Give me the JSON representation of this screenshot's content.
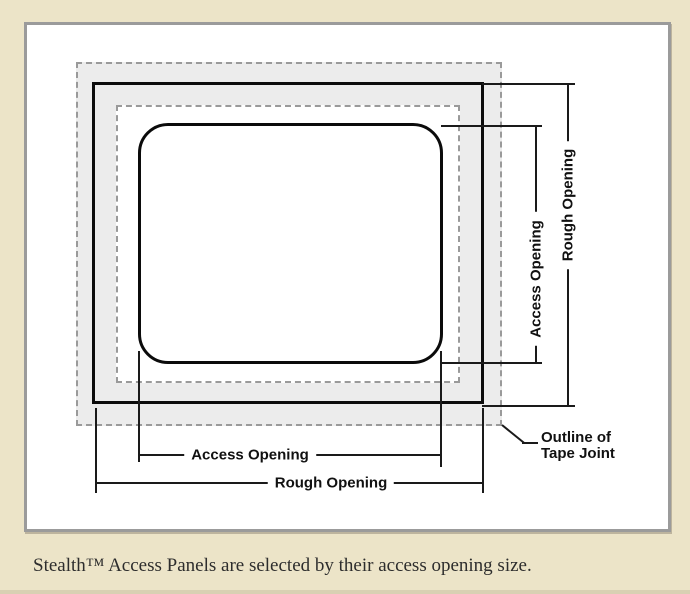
{
  "colors": {
    "page_background": "#ECE4C8",
    "panel_background": "#FFFFFF",
    "panel_border": "#9B9B9B",
    "tape_band_fill": "#ECECEC",
    "dashed_line": "#9A9A9A",
    "solid_line": "#0B0B0B",
    "label_text": "#111111",
    "caption_text": "#2D2D2D"
  },
  "diagram": {
    "labels": {
      "access_opening_bottom": "Access Opening",
      "rough_opening_bottom": "Rough Opening",
      "access_opening_right": "Access Opening",
      "rough_opening_right": "Rough Opening",
      "tape_joint": "Outline of\nTape Joint"
    }
  },
  "caption": "Stealth™ Access Panels are selected by their access opening size."
}
